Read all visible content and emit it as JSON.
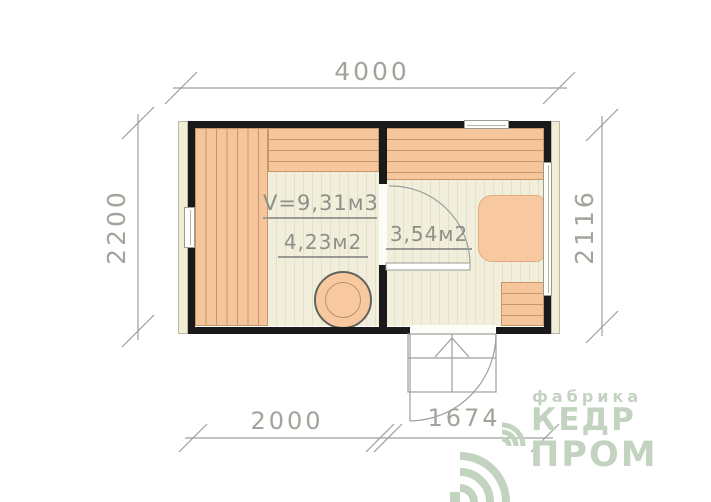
{
  "dimensions": {
    "top": "4000",
    "left": "2200",
    "right": "2116",
    "bottom_left": "2000",
    "bottom_right": "1674"
  },
  "rooms": {
    "steam_room": {
      "volume": "V=9,31м3",
      "area": "4,23м2"
    },
    "washroom": {
      "area": "3,54м2"
    }
  },
  "logo": {
    "tagline": "фабрика",
    "title_top": "КЕДР",
    "title_bottom": "ПРОМ"
  },
  "colors": {
    "wall": "#1a1a1a",
    "plank": "#f5c69b",
    "plank_line": "#c89767",
    "floor": "#f1efdc",
    "floor_line": "#e4e1c8",
    "siding": "#f2eed4",
    "furniture": "#f8c9a0",
    "linework": "#9aa09e",
    "dim_text": "#a3a39b",
    "label_text": "#8f8f89",
    "logo_green": "#c2d3bf"
  }
}
